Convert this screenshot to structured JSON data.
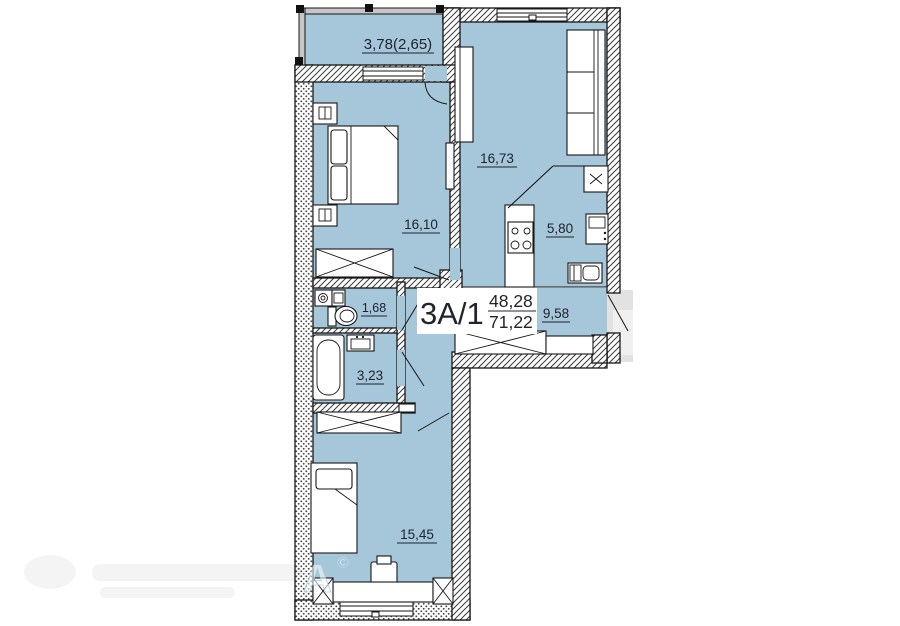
{
  "plan": {
    "unit": {
      "label": "3А/1",
      "upper_area": "48,28",
      "lower_area": "71,22"
    },
    "rooms": [
      {
        "id": "balcony",
        "area": "3,78(2,65)"
      },
      {
        "id": "living-room",
        "area": "16,73"
      },
      {
        "id": "bedroom-top",
        "area": "16,10"
      },
      {
        "id": "kitchen",
        "area": "5,80"
      },
      {
        "id": "wc",
        "area": "1,68"
      },
      {
        "id": "hallway",
        "area": "9,58"
      },
      {
        "id": "bathroom",
        "area": "3,23"
      },
      {
        "id": "bedroom-bottom",
        "area": "15,45"
      }
    ],
    "watermark": {
      "letter": "А",
      "symbol": "©"
    }
  },
  "colors": {
    "floor": "#a6c6da",
    "wall_line": "#161616",
    "label": "#20242e",
    "landing": "#e2e2e2"
  }
}
